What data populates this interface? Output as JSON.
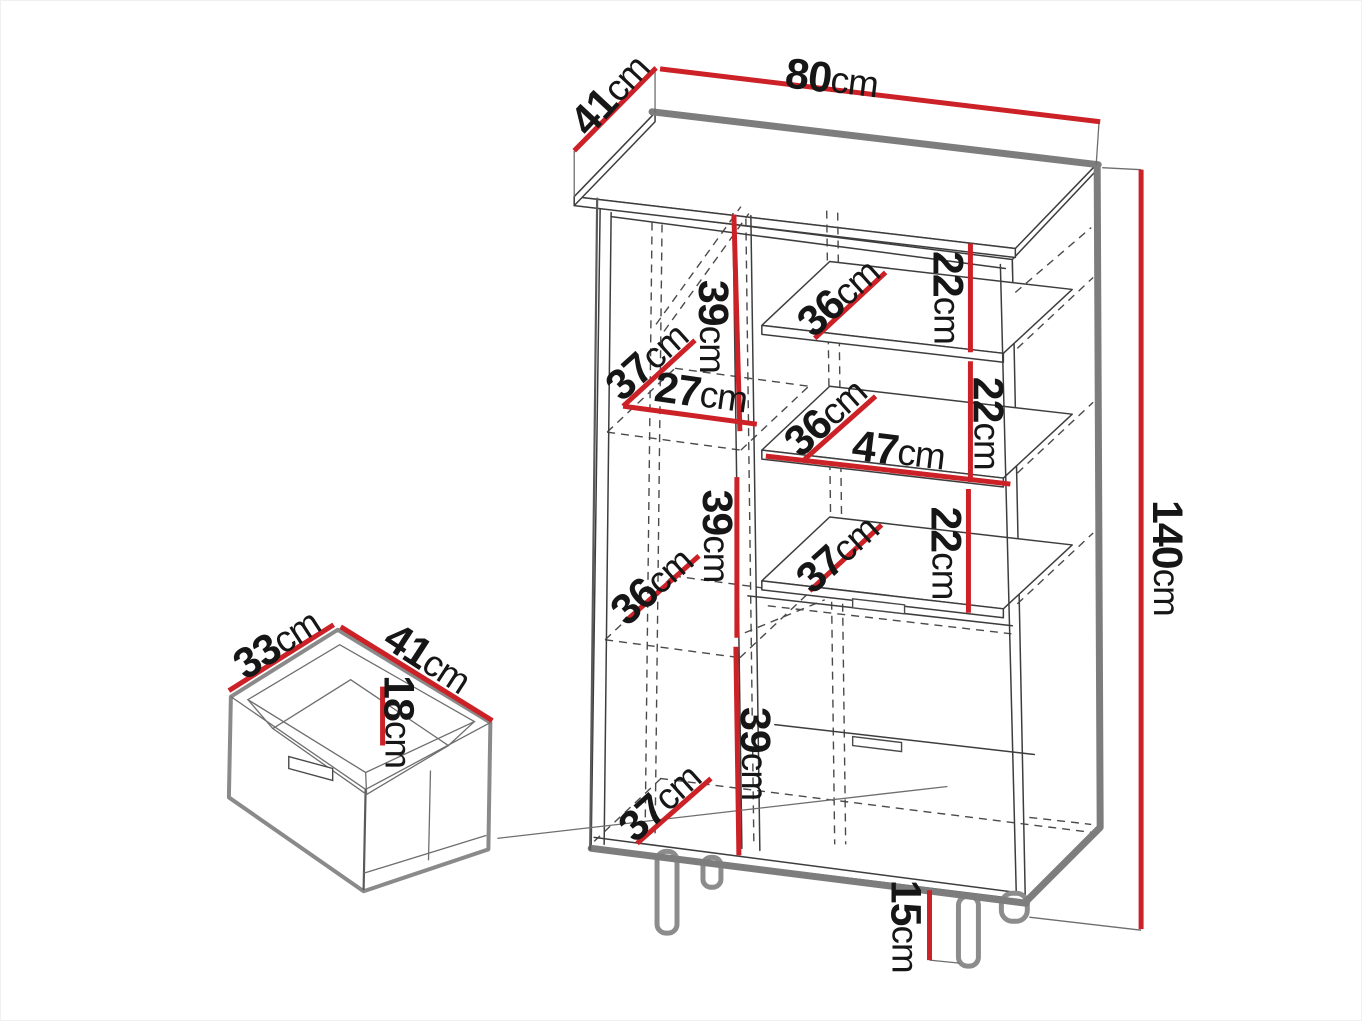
{
  "page": {
    "background": "#ffffff"
  },
  "colors": {
    "dimension_red": "#cc2127",
    "outline_thick_gray": "#7d7d7d",
    "outline_thin": "#3d3d3d",
    "hidden_line_gray": "#4a4a4a",
    "text": "#161616"
  },
  "unit": "cm",
  "main_cabinet": {
    "overall": {
      "width": {
        "num": "80",
        "unit": "cm"
      },
      "depth": {
        "num": "41",
        "unit": "cm"
      },
      "height": {
        "num": "140",
        "unit": "cm"
      },
      "leg_height": {
        "num": "15",
        "unit": "cm"
      }
    },
    "left_column": {
      "top_compartment_height": {
        "num": "39",
        "unit": "cm"
      },
      "top_shelf_depth": {
        "num": "37",
        "unit": "cm"
      },
      "interior_width": {
        "num": "27",
        "unit": "cm"
      },
      "middle_shelf_depth": {
        "num": "36",
        "unit": "cm"
      },
      "middle_compartment_height": {
        "num": "39",
        "unit": "cm"
      },
      "bottom_compartment_height": {
        "num": "39",
        "unit": "cm"
      },
      "floor_depth": {
        "num": "37",
        "unit": "cm"
      }
    },
    "right_column": {
      "top_shelf_depth": {
        "num": "36",
        "unit": "cm"
      },
      "top_compartment_height": {
        "num": "22",
        "unit": "cm"
      },
      "middle_shelf_depth": {
        "num": "36",
        "unit": "cm"
      },
      "interior_width": {
        "num": "47",
        "unit": "cm"
      },
      "middle_compartment_height": {
        "num": "22",
        "unit": "cm"
      },
      "lower_shelf_depth": {
        "num": "37",
        "unit": "cm"
      },
      "lower_compartment_height": {
        "num": "22",
        "unit": "cm"
      }
    }
  },
  "drawer_inset": {
    "depth": {
      "num": "33",
      "unit": "cm"
    },
    "width": {
      "num": "41",
      "unit": "cm"
    },
    "height": {
      "num": "18",
      "unit": "cm"
    }
  }
}
